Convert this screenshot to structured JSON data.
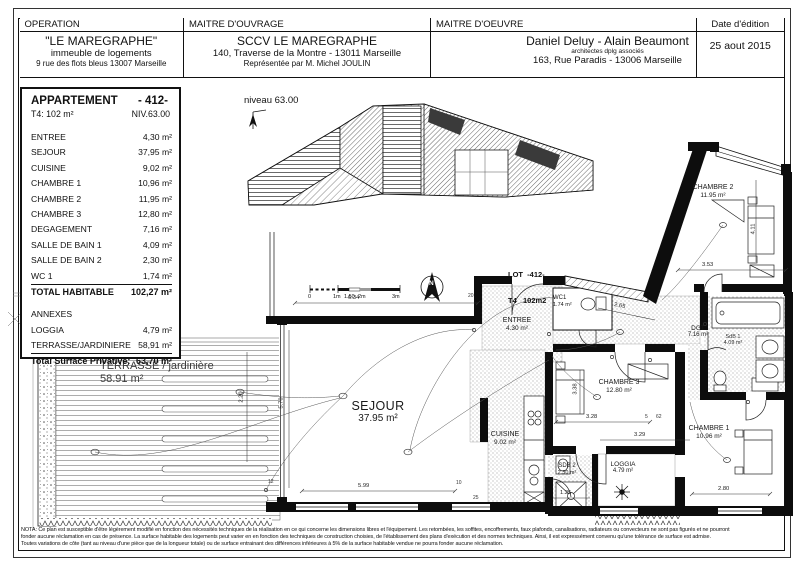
{
  "header": {
    "operation": {
      "label": "OPERATION",
      "title": "\"LE MAREGRAPHE\"",
      "line2": "immeuble de logements",
      "line3": "9 rue des flots bleus 13007 Marseille"
    },
    "maitre_douvrage": {
      "label": "MAITRE D'OUVRAGE",
      "title": "SCCV LE MAREGRAPHE",
      "line2": "140, Traverse de la Montre - 13011 Marseille",
      "line3": "Représentée par M. Michel JOULIN"
    },
    "maitre_doeuvre": {
      "label": "MAITRE D'OEUVRE",
      "title": "Daniel Deluy - Alain Beaumont",
      "line2": "architectes dplg associés",
      "line3": "163, Rue Paradis - 13006 Marseille"
    },
    "date_edition": {
      "label": "Date d'édition",
      "value": "25 aout 2015"
    }
  },
  "apartment_card": {
    "title": "APPARTEMENT",
    "number": "- 412-",
    "type": "T4: 102 m²",
    "level": "NIV.63.00",
    "rooms": [
      {
        "name": "ENTREE",
        "area": "4,30 m²"
      },
      {
        "name": "SEJOUR",
        "area": "37,95 m²"
      },
      {
        "name": "CUISINE",
        "area": "9,02 m²"
      },
      {
        "name": "CHAMBRE 1",
        "area": "10,96 m²"
      },
      {
        "name": "CHAMBRE 2",
        "area": "11,95 m²"
      },
      {
        "name": "CHAMBRE 3",
        "area": "12,80 m²"
      },
      {
        "name": "DEGAGEMENT",
        "area": "7,16 m²"
      },
      {
        "name": "SALLE DE BAIN 1",
        "area": "4,09 m²"
      },
      {
        "name": "SALLE DE BAIN 2",
        "area": "2,30 m²"
      },
      {
        "name": "WC 1",
        "area": "1,74 m²"
      }
    ],
    "total_habitable": {
      "name": "TOTAL HABITABLE",
      "area": "102,27 m²"
    },
    "annexes_label": "ANNEXES",
    "annexes": [
      {
        "name": "LOGGIA",
        "area": "4,79 m²"
      },
      {
        "name": "TERRASSE/JARDINIERE",
        "area": "58,91 m²"
      }
    ],
    "total_privative": {
      "name": "Total Surface Privative:",
      "area": "63,70 m²"
    }
  },
  "key_plan": {
    "level_label": "niveau 63.00"
  },
  "plan": {
    "lot_line1": "LOT  -412-",
    "lot_line2": "T4   102m2",
    "north_letter": "N",
    "rooms": {
      "terrasse": {
        "name": "TERRASSE / jardinière",
        "area": "58.91 m²"
      },
      "sejour": {
        "name": "SEJOUR",
        "area": "37.95 m²"
      },
      "cuisine": {
        "name": "CUISINE",
        "area": "9.02 m²"
      },
      "entree": {
        "name": "ENTREE",
        "area": "4.30 m²"
      },
      "wc1": {
        "name": "WC1",
        "area": "1.74 m²"
      },
      "dgt": {
        "name": "DGT",
        "area": "7.16 m²"
      },
      "sdb1": {
        "name": "SdB 1",
        "area": "4.09 m²"
      },
      "sdb2": {
        "name": "SDB 2",
        "area": "2.30 m²"
      },
      "chambre1": {
        "name": "CHAMBRE 1",
        "area": "10.96 m²"
      },
      "chambre2": {
        "name": "CHAMBRE 2",
        "area": "11.95 m²"
      },
      "chambre3": {
        "name": "CHAMBRE 3",
        "area": "12.80 m²"
      },
      "loggia": {
        "name": "LOGGIA",
        "area": "4.79 m²"
      }
    },
    "scale_ticks": [
      "0",
      "1m",
      "1.50",
      "2m",
      "3m"
    ],
    "dimensions": {
      "sejour_width": "6.34",
      "sejour_bottom": "5.99",
      "sejour_height": "5.70",
      "terrasse_height": "2.20",
      "chambre2_width": "3.53",
      "chambre2_height": "4.11",
      "dgt_length": "2.65",
      "chambre3_width": "3.28",
      "chambre3_height": "3.38",
      "chambre1_width": "2.80",
      "sdb2_width": "1.25",
      "loggia_width": "3.29"
    },
    "small_marks": [
      "20",
      "12",
      "10",
      "25",
      "5",
      "62"
    ]
  },
  "nota": {
    "line1": "NOTA: Ce plan est susceptible d'être légèrement modifié en fonction des nécessités techniques de la réalisation en ce qui concerne les dimensions libres et l'équipement. Les retombées, les soffites, encoffrements, faux plafonds, canalisations, radiateurs ou convecteurs ne sont pas figurés et ne pourront",
    "line2": "fonder aucune réclamation en cas de présence. La surface habitable des logements peut varier en en fonction des techniques de construction choisies, de l'établissement des plans d'exécution et des normes techniques. Ainsi, il est expressément convenu qu'une tolérance de surface est admise.",
    "line3": "Toutes variations de côte (tant au niveau d'une pièce que de la longueur totale) ou de surface entrainant des différences inférieures à 5% de la surface habitable vendue ne pourra fonder aucune réclamation."
  }
}
